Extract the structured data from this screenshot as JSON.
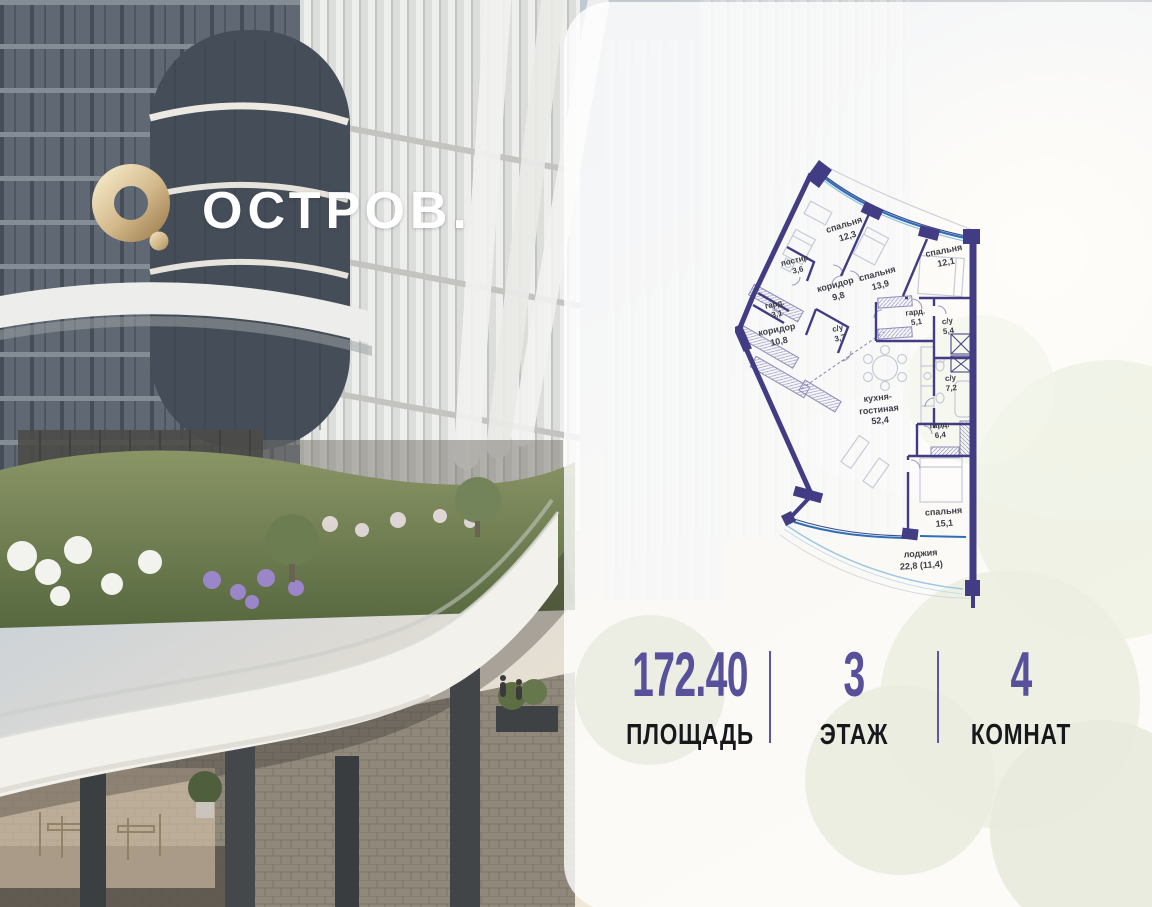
{
  "logo": {
    "brand": "ОСТРОВ.",
    "icon": "ostrov-ring-icon"
  },
  "floorplan": {
    "rooms": [
      {
        "name": "спальня",
        "area": "12,3",
        "x": 111,
        "y": 81,
        "rot": -17
      },
      {
        "name": "спальня",
        "area": "13,9",
        "x": 144,
        "y": 130,
        "rot": -15
      },
      {
        "name": "спальня",
        "area": "12,1",
        "x": 210,
        "y": 107,
        "rot": -11
      },
      {
        "name": "постир.",
        "area": "3,6",
        "x": 62,
        "y": 116,
        "rot": -13,
        "small": true
      },
      {
        "name": "коридор",
        "area": "9,8",
        "x": 102,
        "y": 141,
        "rot": -15
      },
      {
        "name": "гард.",
        "area": "3,1",
        "x": 41,
        "y": 160,
        "rot": -13,
        "small": true
      },
      {
        "name": "коридор",
        "area": "10,8",
        "x": 43,
        "y": 186,
        "rot": -11
      },
      {
        "name": "с/у",
        "area": "3,7",
        "x": 104,
        "y": 184,
        "rot": -13,
        "small": true
      },
      {
        "name": "гард.",
        "area": "5,1",
        "x": 181,
        "y": 168,
        "rot": -7,
        "small": true
      },
      {
        "name": "с/у",
        "area": "5,4",
        "x": 213,
        "y": 177,
        "rot": -7,
        "small": true
      },
      {
        "name": "с/у",
        "area": "7,2",
        "x": 216,
        "y": 234,
        "rot": -5,
        "small": true
      },
      {
        "name": "кухня-\nгостиная",
        "area": "52,4",
        "x": 144,
        "y": 260,
        "rot": -6
      },
      {
        "name": "гард.",
        "area": "6,4",
        "x": 205,
        "y": 281,
        "rot": -5,
        "small": true
      },
      {
        "name": "спальня",
        "area": "15,1",
        "x": 209,
        "y": 368,
        "rot": -4
      },
      {
        "name": "лоджия",
        "area": "22,8 (11,4)",
        "x": 186,
        "y": 410,
        "rot": -4
      }
    ]
  },
  "stats": {
    "area": {
      "value": "172.40",
      "label": "ПЛОЩАДЬ"
    },
    "floor": {
      "value": "3",
      "label": "ЭТАЖ"
    },
    "rooms": {
      "value": "4",
      "label": "КОМНАТ"
    }
  },
  "colors": {
    "accent_purple": "#57509B",
    "plan_wall": "#413C83",
    "plan_window": "#2E72B8",
    "logo_gold": "#C9A97C"
  }
}
